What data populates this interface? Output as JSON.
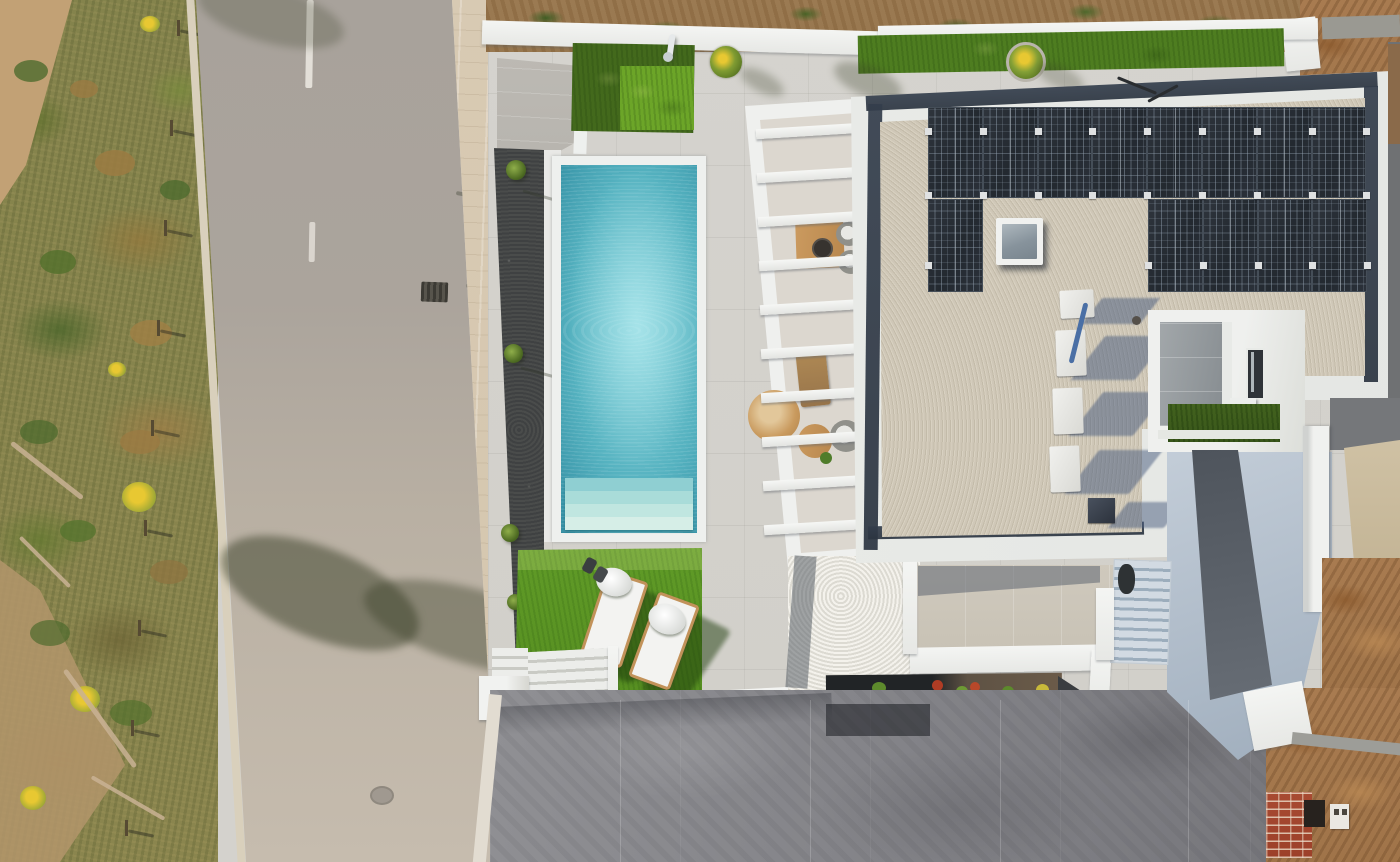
{
  "image_type": "aerial-drone-photograph",
  "description": "Top-down aerial photo of a modern white villa with turquoise pool, artificial lawn with two sun loungers, pergola terrace, gravel flat roof with 13 solar panels, skylight, HVAC units, inner courtyard, large concrete driveway, asphalt road with scrubland on the left and construction dirt plots on the right.",
  "labels": {
    "scene": "Aerial view of modern villa",
    "vegetation": "Roadside scrubland with dry grass and yellow wildflowers",
    "road": "Asphalt street with dashed center line",
    "sidewalk": "Concrete paver sidewalk",
    "pool": "Rectangular turquoise swimming pool with roman steps",
    "lawn": "Artificial turf sunbathing lawn",
    "loungers": "Two white sun loungers with towels",
    "pergola": "White slatted pergola over outdoor lounge and dining furniture",
    "roof": "Flat gravel roof with white parapet and dark gravel edge strip",
    "solar": "Photovoltaic solar panel array (8 top row, 1 left, 4 right block)",
    "skylight": "Square roof skylight",
    "hvac": "Rooftop HVAC / utility units with long shadows",
    "courtyard": "Recessed inner courtyard patio with turf strip",
    "driveway": "Broom-finished concrete driveway",
    "planter": "Planter bed with small shrubs and red flowers",
    "stairs": "Exterior entry staircase",
    "neighbor": "Neighboring plot under construction with brick wall and dirt"
  },
  "counts": {
    "solar_panels_row1": 8,
    "solar_panels_row2_left": 1,
    "solar_panels_row2_right": 4,
    "pergola_slats": 10,
    "sun_loungers": 2,
    "hvac_units": 4,
    "lane_dashes": 2
  },
  "palette": {
    "veg_base": "#84834c",
    "road_top": "#a8a29b",
    "road_bottom": "#c6bcae",
    "sidewalk": "#d8cab3",
    "deck_concrete": "#d4d2cd",
    "wall_white": "#f0f1ef",
    "grass_dark": "#4f7c20",
    "grass_bright": "#6ca528",
    "lawn_green": "#5f9a26",
    "pool_deep": "#1e7287",
    "pool_light": "#8ad4dc",
    "roof_gravel": "#cfc7b7",
    "gravel_edge": "#333d4b",
    "solar_panel": "#272d34",
    "shadow_blue": "#5c6c85",
    "apron_blue": "#b7c3d0",
    "driveway_gray": "#8d8d91",
    "dirt_brown": "#a5784f",
    "brick_red": "#a84a32",
    "wood_tan": "#c6945c",
    "flower_yellow": "#e8c832"
  }
}
